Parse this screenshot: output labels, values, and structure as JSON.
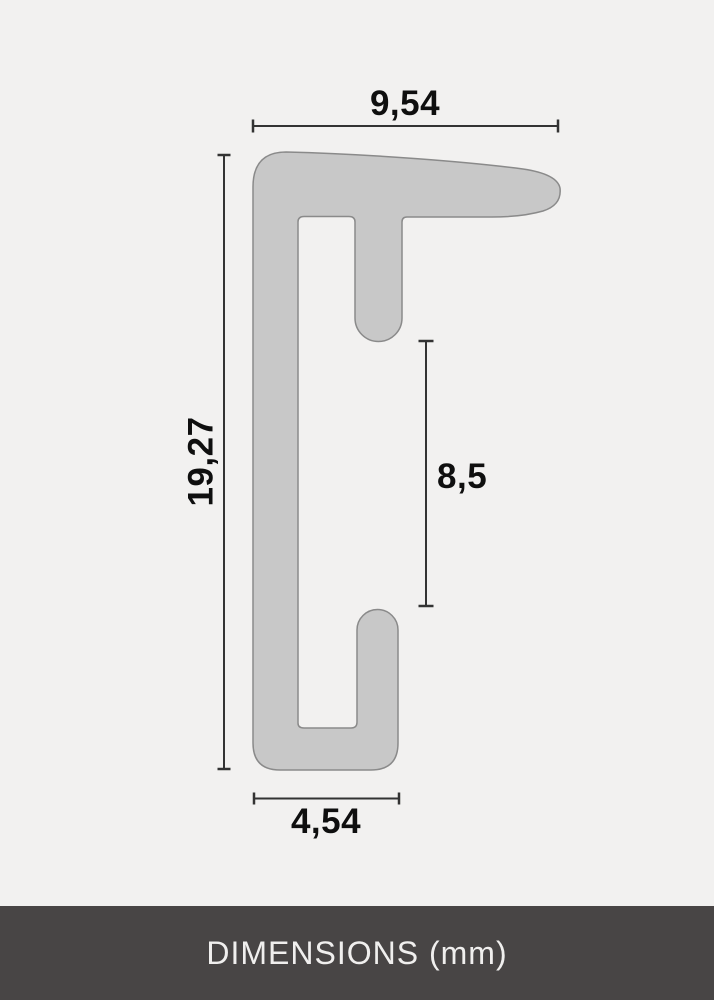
{
  "diagram": {
    "type": "frame-profile-cross-section",
    "measurements": {
      "top_width": "9,54",
      "left_height": "19,27",
      "inner_depth": "8,5",
      "bottom_width": "4,54"
    }
  },
  "footer": {
    "title": "DIMENSIONS (mm)"
  },
  "colors": {
    "page-bg": "#f2f1f0",
    "shape-fill": "#c8c8c8",
    "shape-stroke": "#8a8a8a",
    "dim-line": "#333333",
    "dim-text": "#0f0f0f",
    "footer-bg": "#484545",
    "footer-text": "#f0efee"
  }
}
